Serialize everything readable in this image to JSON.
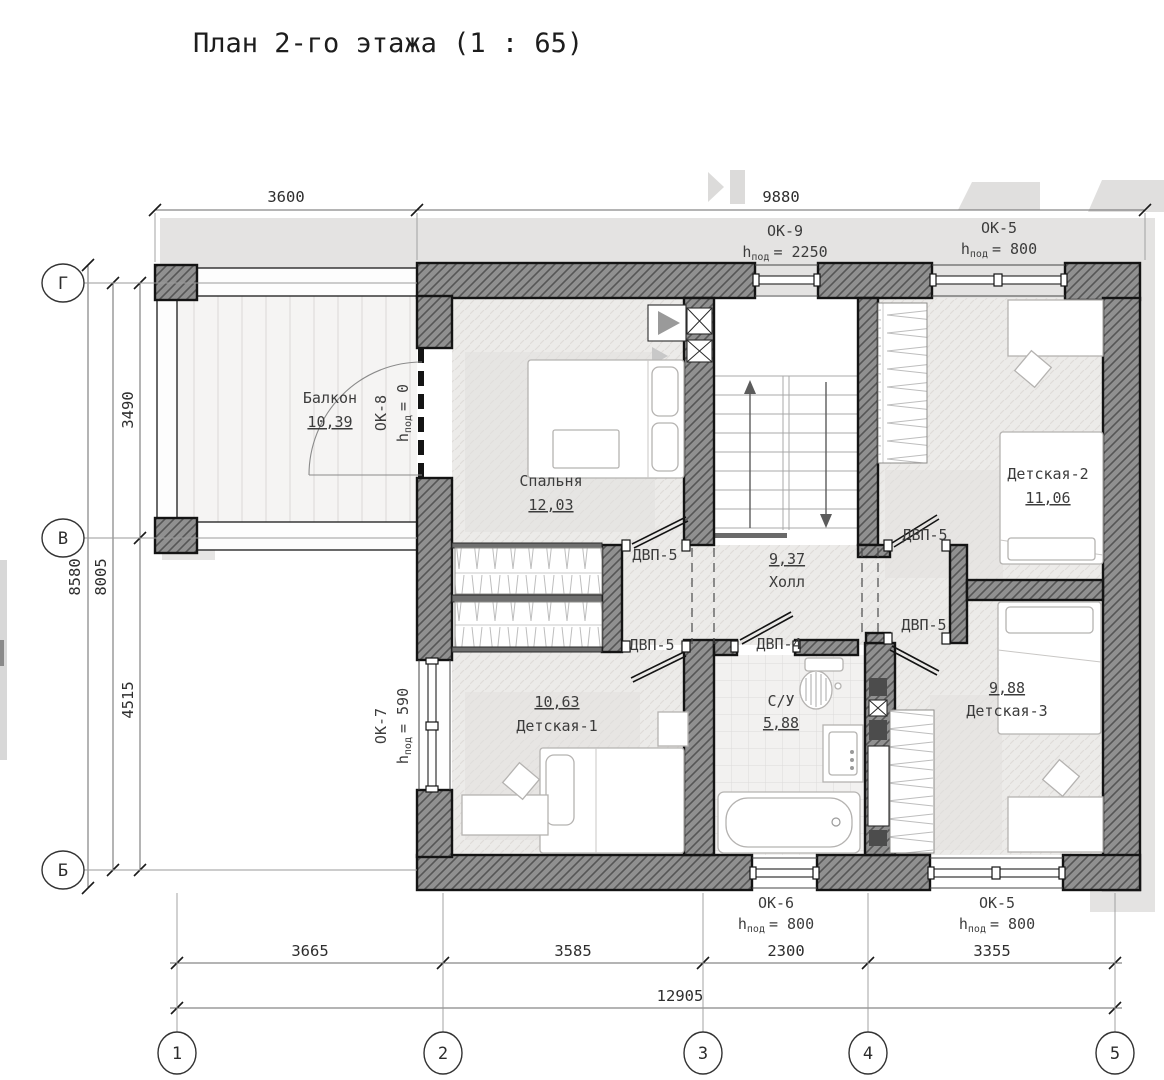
{
  "title": "План 2-го этажа (1 : 65)",
  "grid": {
    "cols": [
      "1",
      "2",
      "3",
      "4",
      "5"
    ],
    "rows": [
      "Г",
      "В",
      "Б"
    ]
  },
  "dims": {
    "top": [
      "3600",
      "9880"
    ],
    "left": {
      "overall": "8580",
      "inner": "8005",
      "segments": [
        "3490",
        "4515"
      ]
    },
    "bottom": {
      "segments": [
        "3665",
        "3585",
        "2300",
        "3355"
      ],
      "overall": "12905"
    }
  },
  "rooms": {
    "balcony": {
      "name": "Балкон",
      "area": "10,39"
    },
    "bedroom": {
      "name": "Спальня",
      "area": "12,03"
    },
    "kids2": {
      "name": "Детская-2",
      "area": "11,06"
    },
    "hall": {
      "name": "Холл",
      "area": "9,37"
    },
    "kids1": {
      "name": "Детская-1",
      "area": "10,63"
    },
    "bath": {
      "name": "С/У",
      "area": "5,88"
    },
    "kids3": {
      "name": "Детская-3",
      "area": "9,88"
    }
  },
  "windows": {
    "ok9": {
      "code": "ОК-9",
      "h": "h",
      "sub": "под",
      "eq": "= 2250"
    },
    "ok5_top": {
      "code": "ОК-5",
      "h": "h",
      "sub": "под",
      "eq": "= 800"
    },
    "ok8": {
      "code": "ОК-8",
      "h": "h",
      "sub": "под",
      "eq": "= 0"
    },
    "ok7": {
      "code": "ОК-7",
      "h": "h",
      "sub": "под",
      "eq": "= 590"
    },
    "ok6": {
      "code": "ОК-6",
      "h": "h",
      "sub": "под",
      "eq": "= 800"
    },
    "ok5_bot": {
      "code": "ОК-5",
      "h": "h",
      "sub": "под",
      "eq": "= 800"
    }
  },
  "doors": {
    "bedroom": "ДВП-5",
    "kids2": "ДВП-5",
    "kids1": "ДВП-5",
    "bath": "ДВП-4",
    "kids3": "ДВП-5"
  },
  "colors": {
    "wall": "#909090",
    "wall_hatch": "#565656",
    "roof": "#e4e3e2",
    "floor": "#ecebe9",
    "tile": "#f2f1f0",
    "ink": "#1a1a1a"
  }
}
